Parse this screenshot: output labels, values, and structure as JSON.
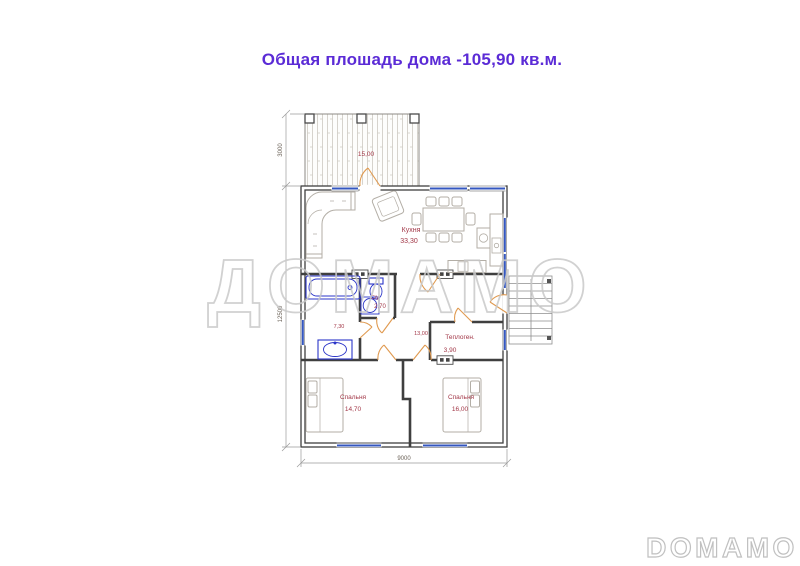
{
  "title": {
    "text": "Общая плошадь дома -105,90 кв.м."
  },
  "watermark": {
    "center": "ДОМАМО",
    "corner": "DOMAMO"
  },
  "plan": {
    "terrace": {
      "area": "15,00"
    },
    "rooms": {
      "kitchen": {
        "name": "Кухня",
        "area": "33,30"
      },
      "wc": {
        "name": "С/у",
        "area": "2,70"
      },
      "bath": {
        "area": "7,30"
      },
      "hall": {
        "area": "13,00"
      },
      "boiler": {
        "name": "Теплоген.",
        "area": "3,90"
      },
      "bedroom1": {
        "name": "Спальня",
        "area": "14,70"
      },
      "bedroom2": {
        "name": "Спальня",
        "area": "16,00"
      }
    },
    "dimensions": {
      "terrace_depth": "3000",
      "left_total": "12500",
      "bottom_width": "9000"
    }
  },
  "colors": {
    "title": "#5b2bd6",
    "wall": "#3f3f3f",
    "window": "#3457c0",
    "fixture": "#2b35c8",
    "door": "#e09a50",
    "room_label": "#a23747",
    "furniture": "#b3aea6",
    "dimension": "#8a8a8a",
    "watermark": "#c9c9c9"
  }
}
